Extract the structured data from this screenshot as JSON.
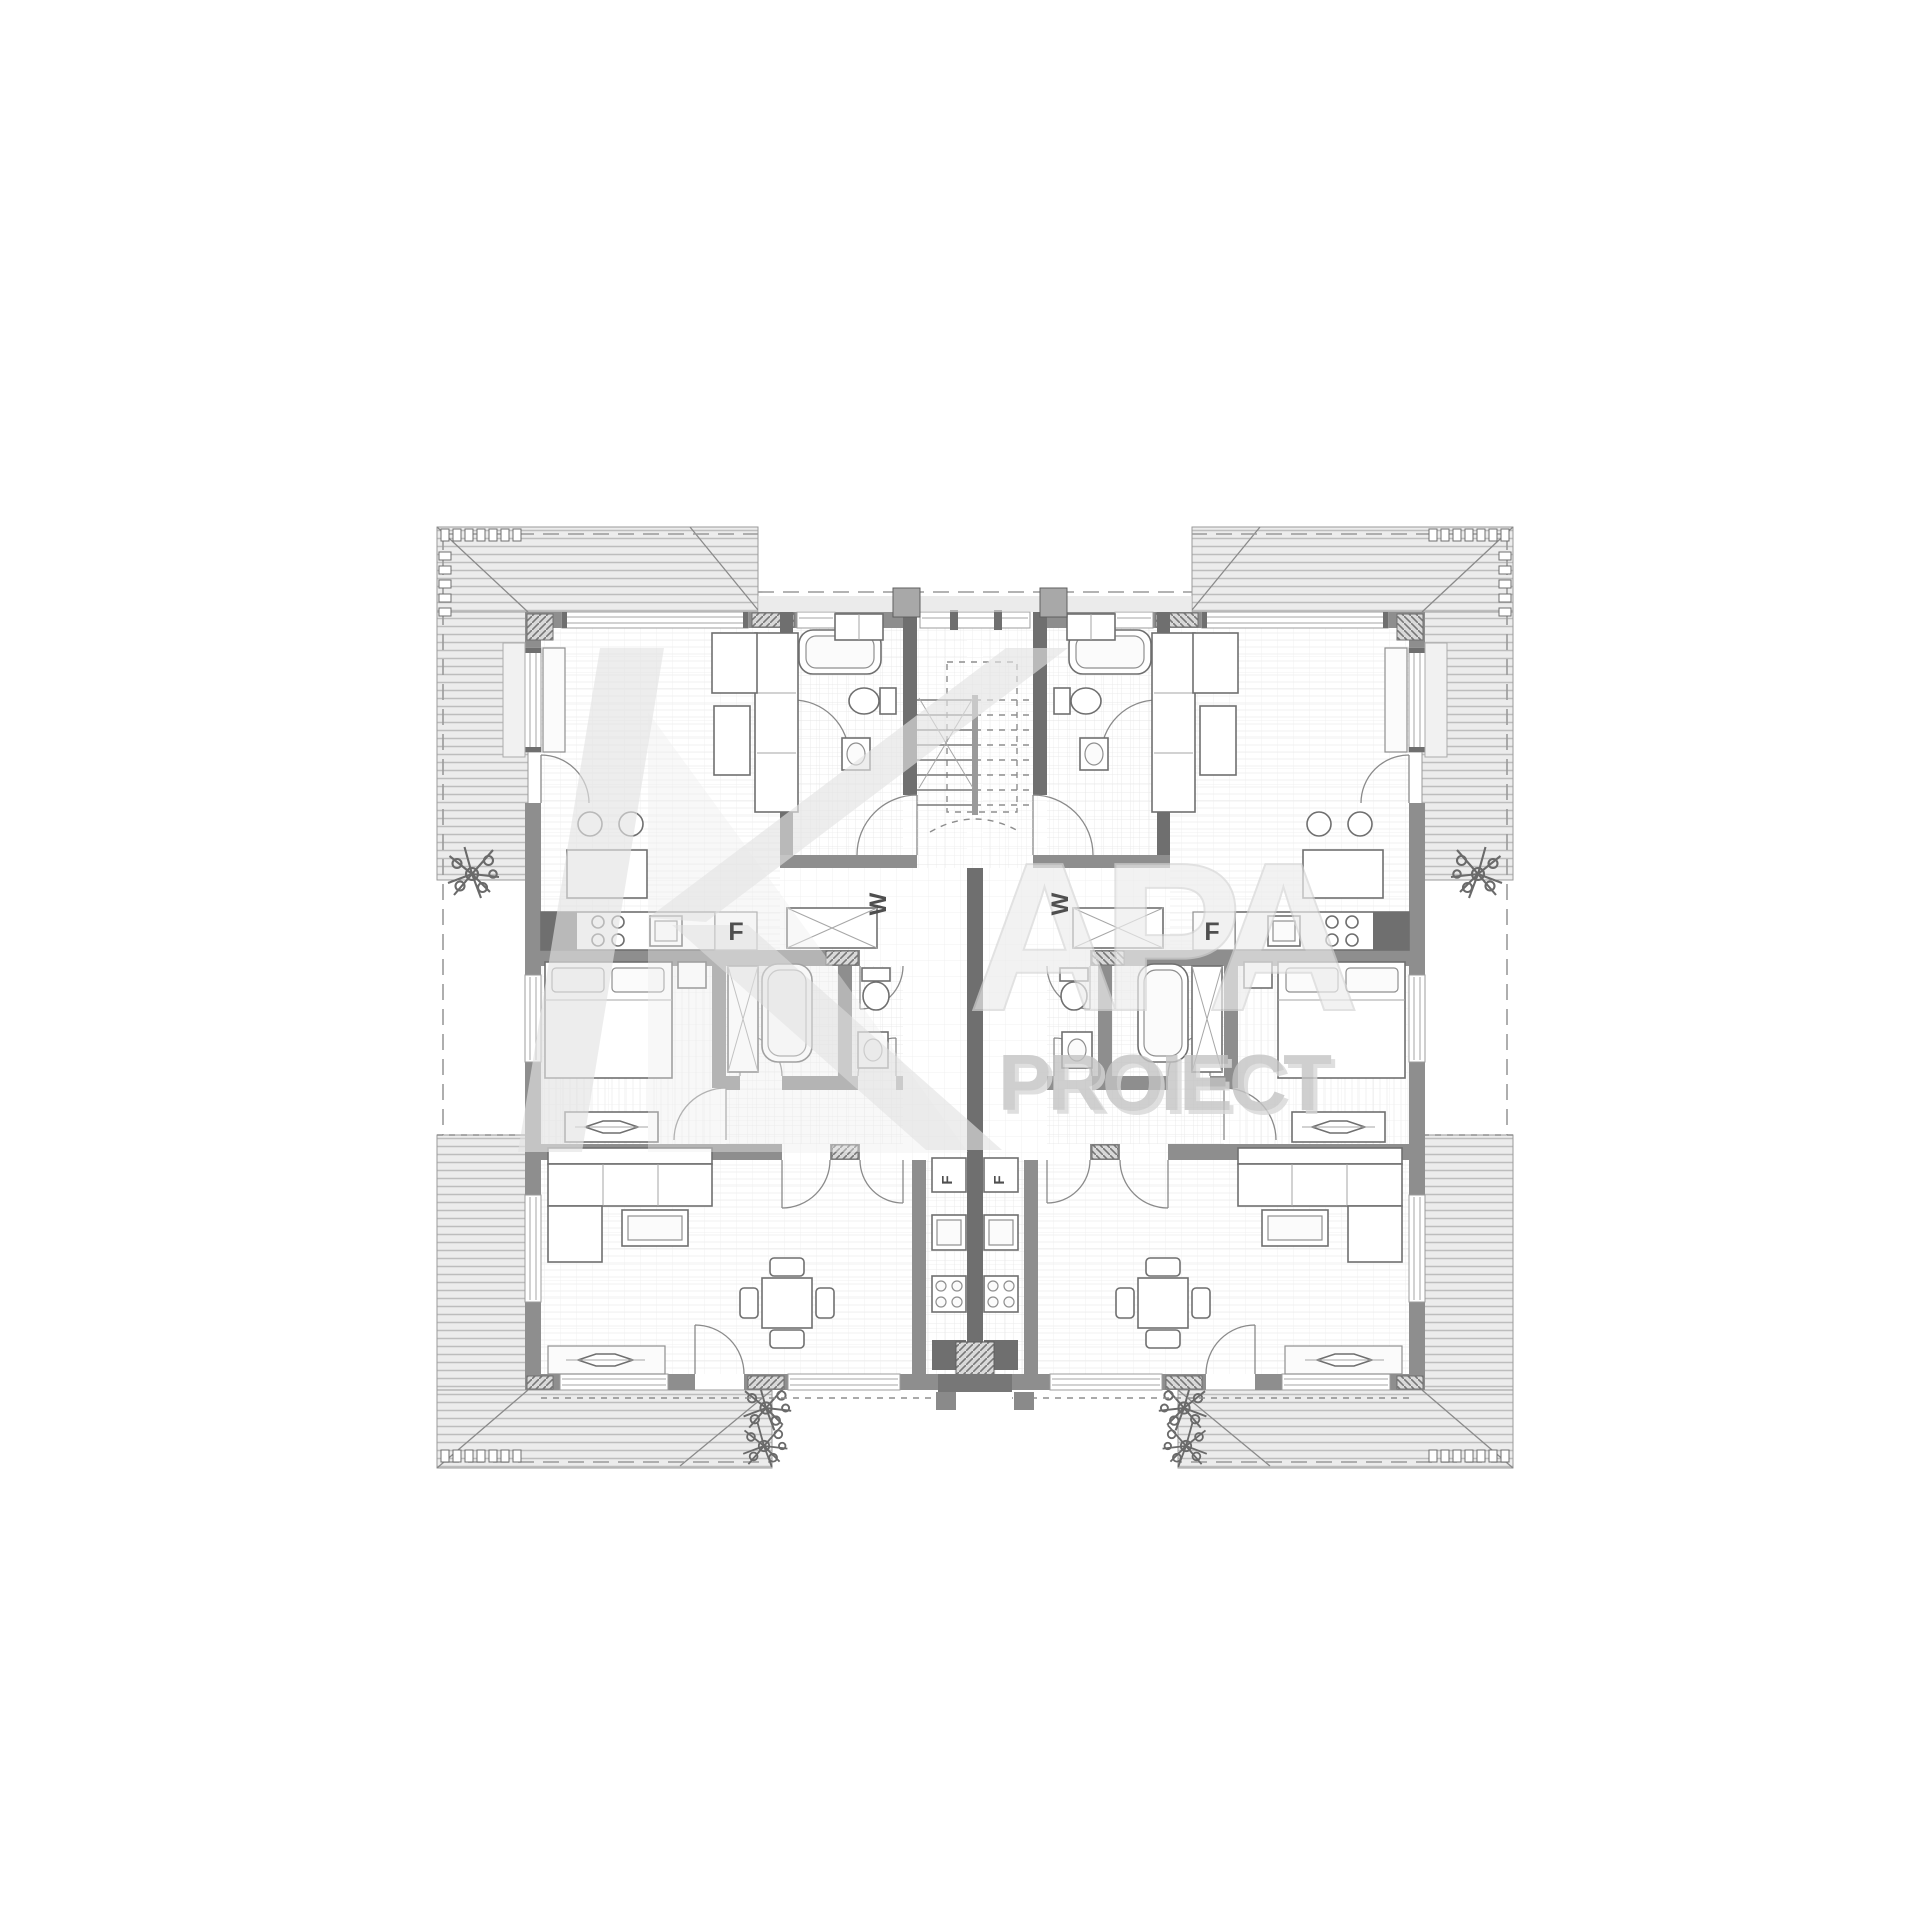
{
  "watermark": {
    "word": "PROIECT",
    "ghost_letters": "APA",
    "logo_letter": "K",
    "word_color": "#c3c3c3",
    "ghost_color": "#ededed",
    "logo_color": "#e3e3e3"
  },
  "labels": {
    "wardrobe_left": "W",
    "wardrobe_right": "W",
    "fridge_left": "F",
    "fridge_right": "F",
    "kitchen_appliance_left": "F",
    "kitchen_appliance_right": "F"
  },
  "colors": {
    "background": "#ffffff",
    "wall": "#8e8e8e",
    "wall_dark": "#6f6f6f",
    "roof_fill": "#ececec",
    "roof_line": "#bdbdbd",
    "drawing_line": "#8a8a8a",
    "floor_grid": "#e3e3e3"
  }
}
